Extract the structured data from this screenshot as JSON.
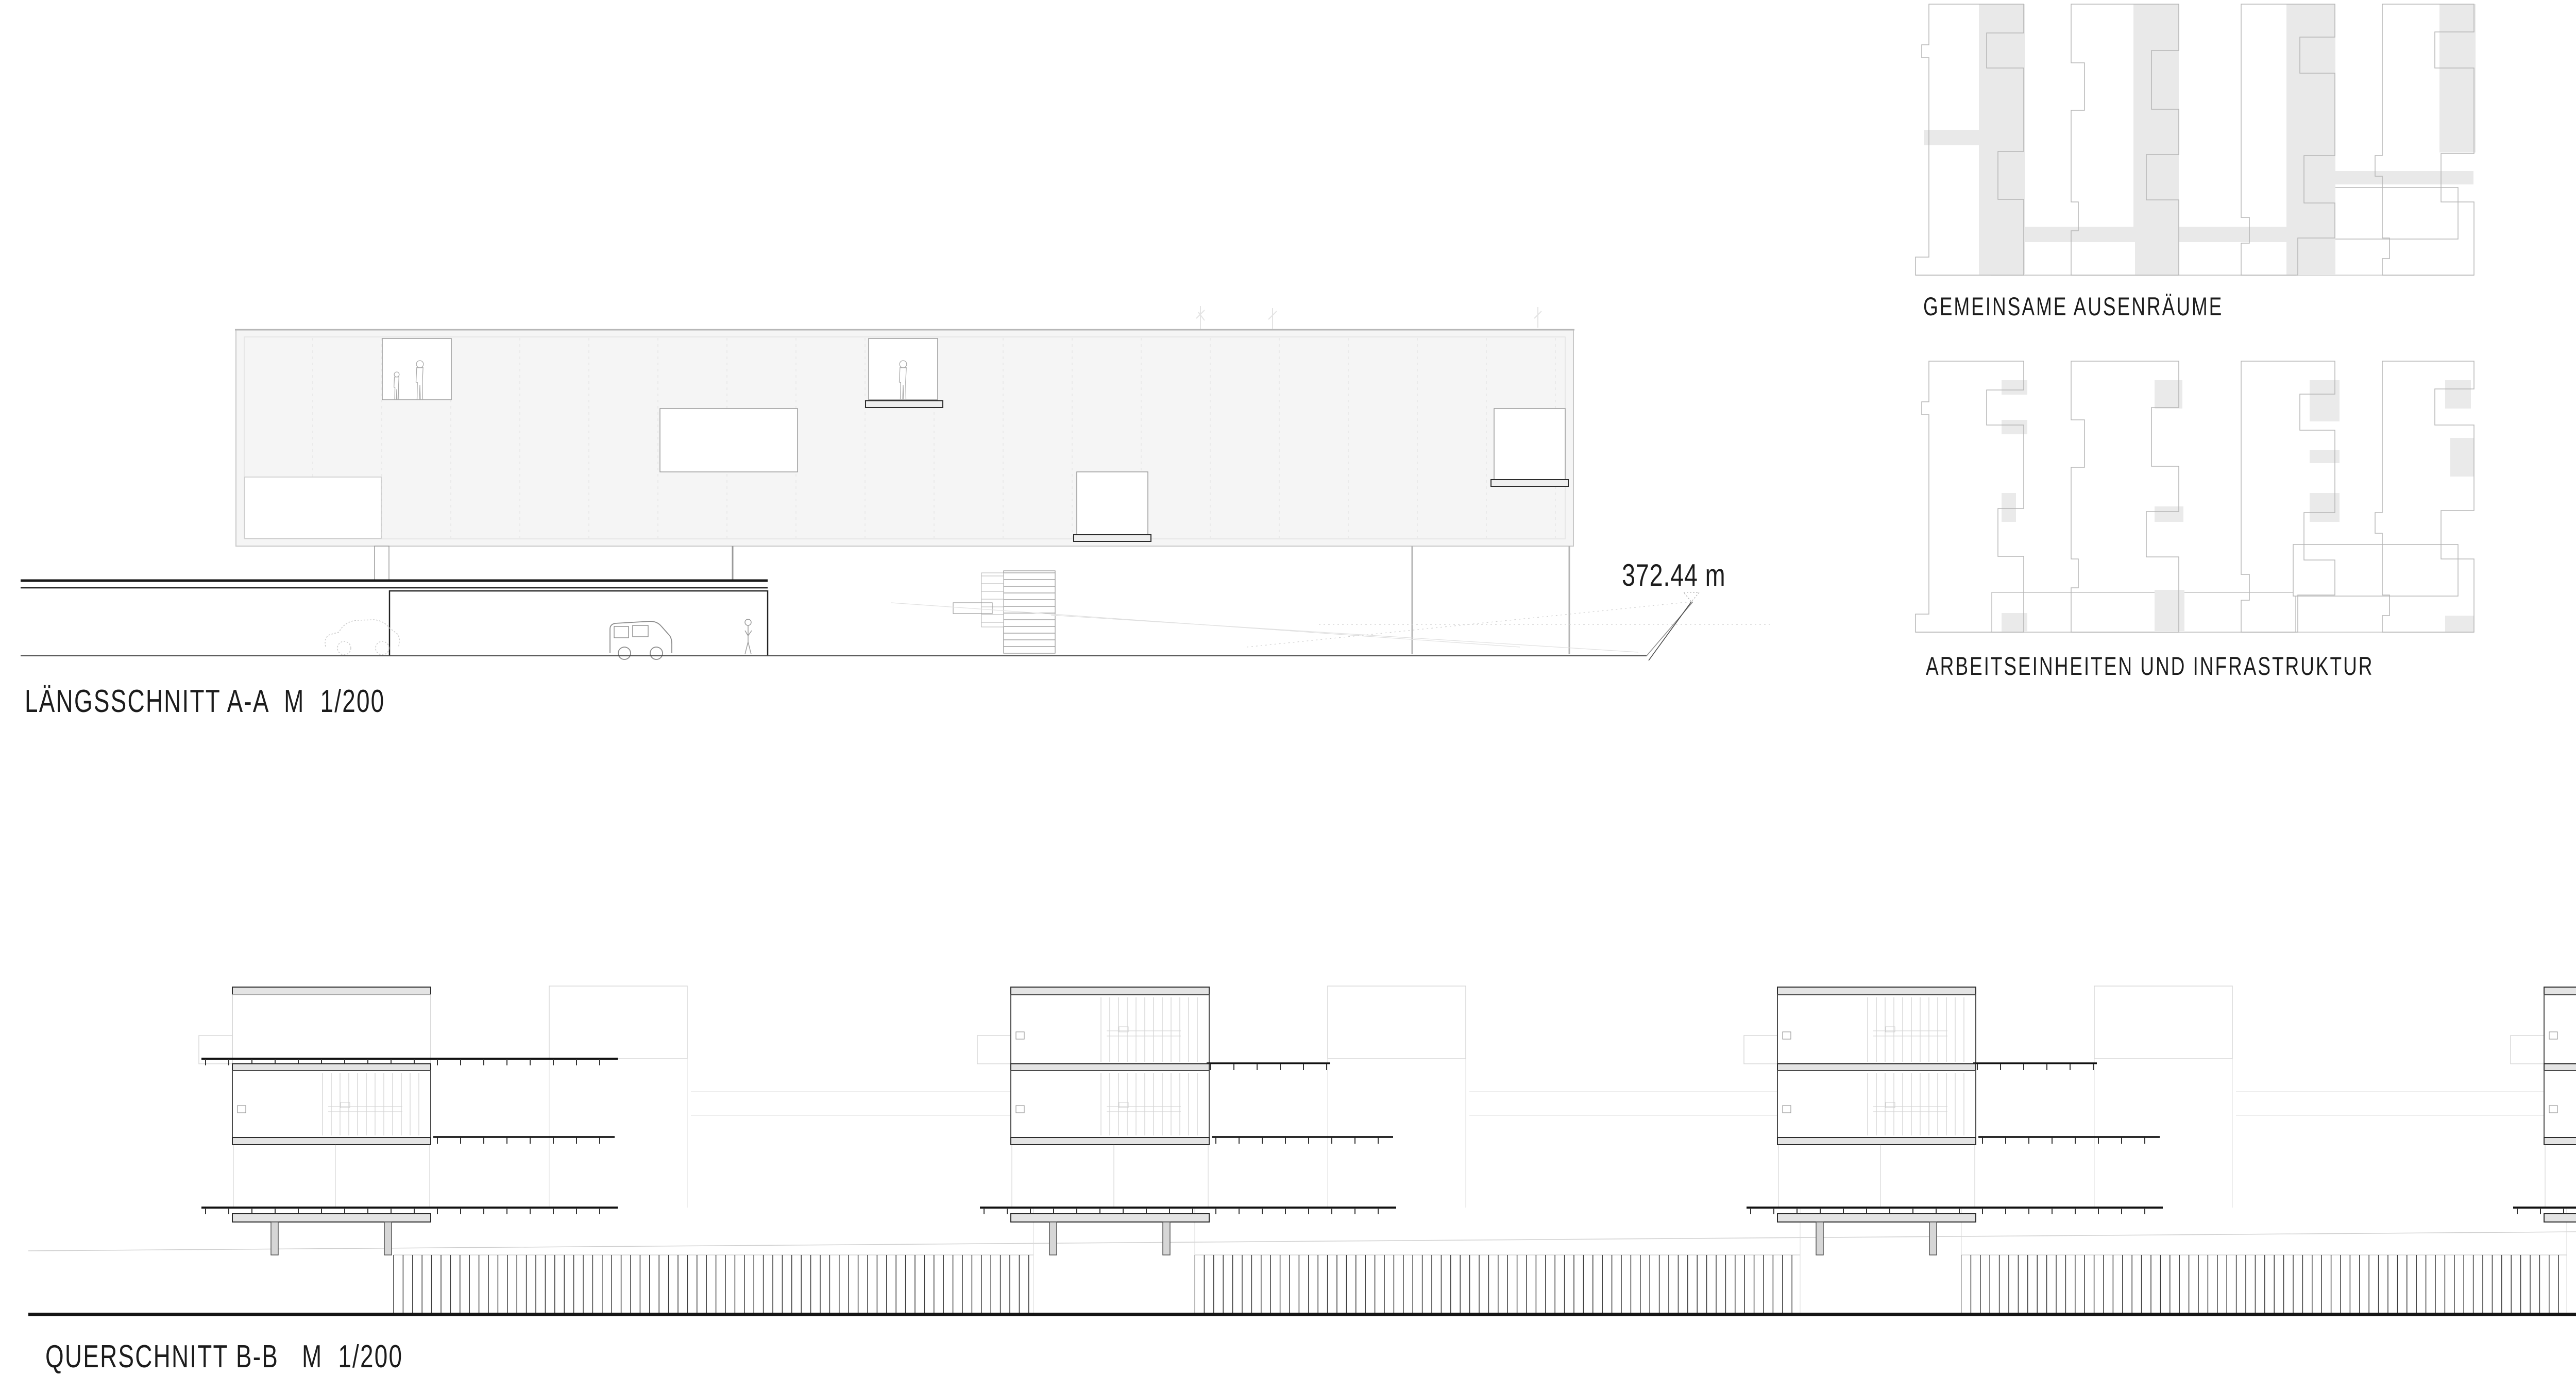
{
  "sheet": {
    "background": "#ffffff",
    "type": "architectural presentation board"
  },
  "labels": {
    "laengsschnitt": "LÄNGSSCHNITT A-A  M  1/200",
    "querschnitt": "QUERSCHNITT B-B   M  1/200",
    "elevation": "372.44 m",
    "plan_1": "GEMEINSAME AUSENRÄUME",
    "plan_2": "ZELLEN",
    "plan_3": "ARBEITSEINHEITEN UND INFRASTRUKTUR",
    "plan_4": "GETEILTE INNEN RÄUME"
  },
  "colors": {
    "ink": "#1a1a1a",
    "dark_line": "#2b2b2b",
    "mid_line": "#8f8f8f",
    "light_line": "#c8c8c8",
    "faint_line": "#e2e2e2",
    "building_fill": "#f5f5f5",
    "slab_fill": "#e4e4e4",
    "plan_gray": "#e9e9e9",
    "stub_fill": "#d6d6d6"
  }
}
